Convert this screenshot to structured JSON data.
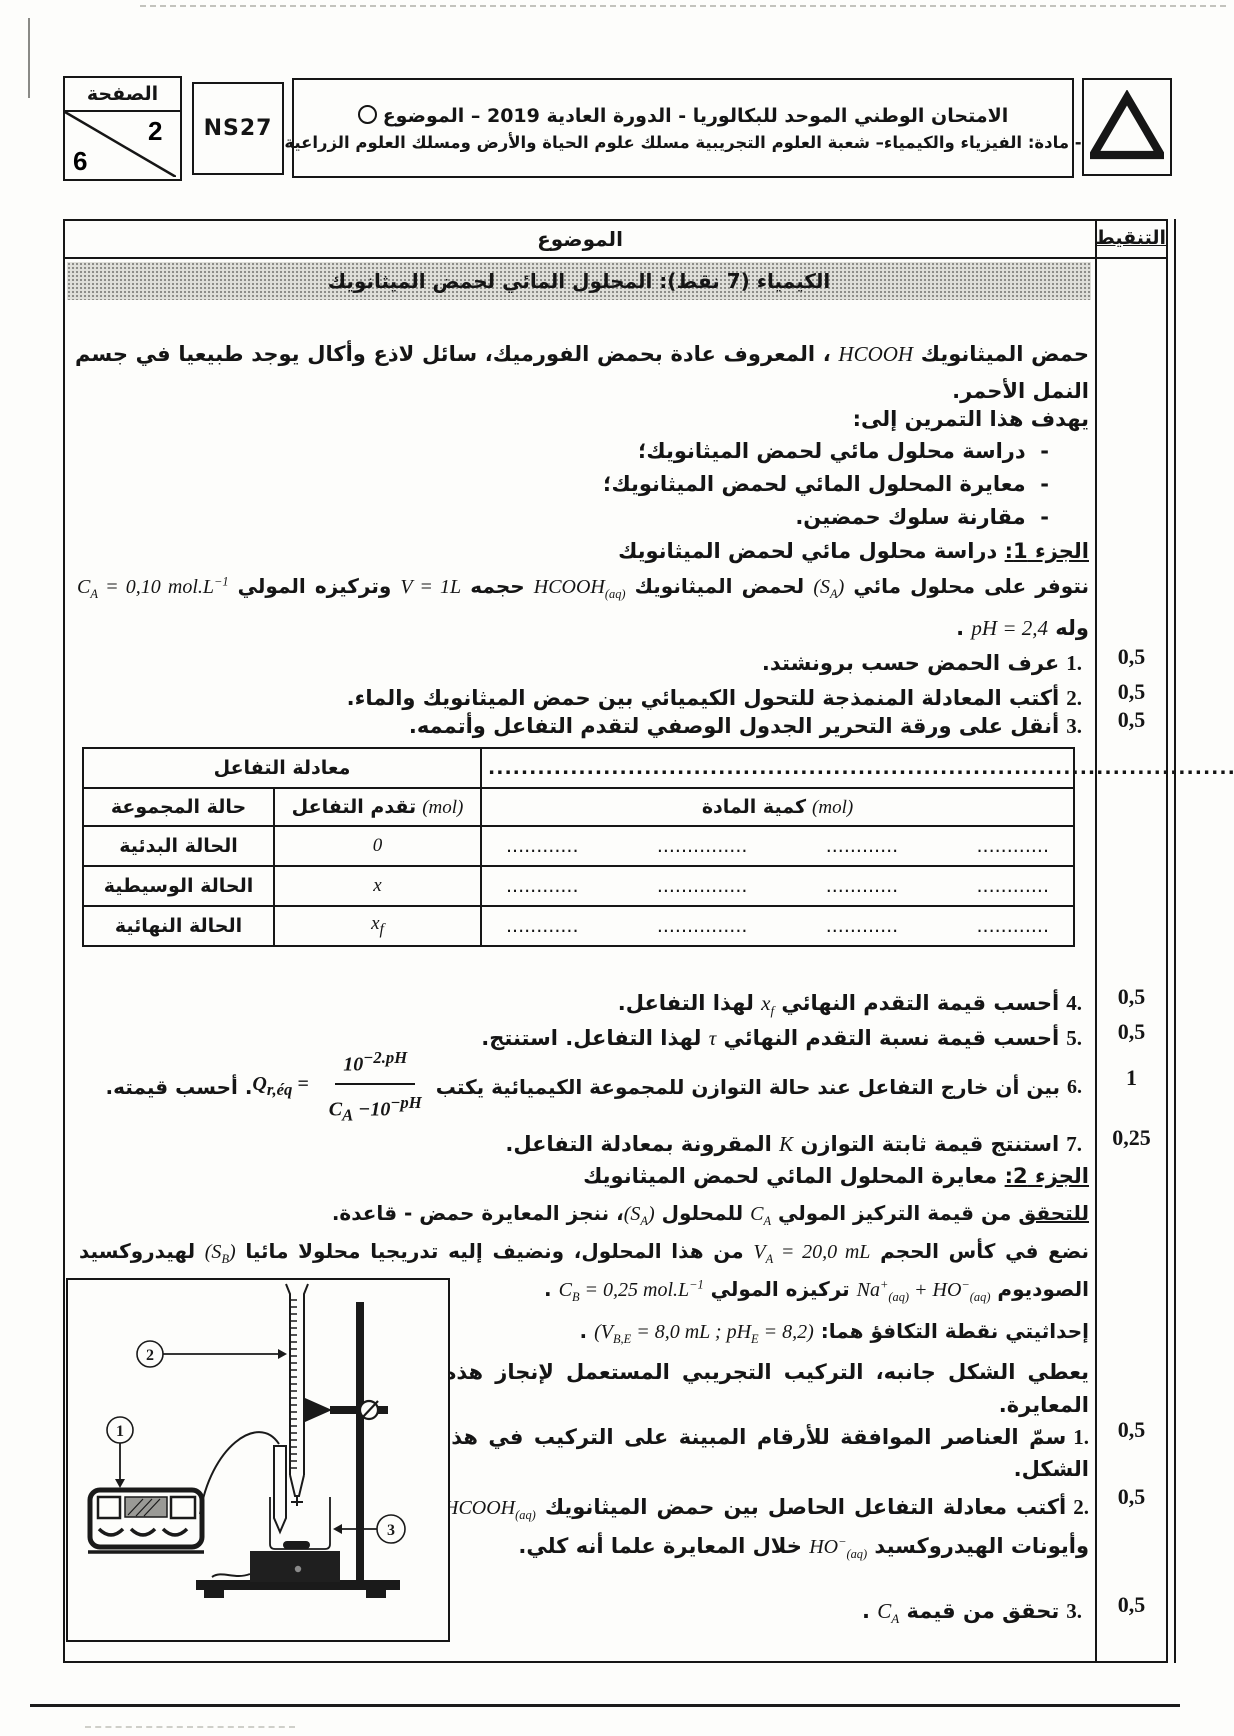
{
  "header": {
    "page_label": "الصفحة",
    "page_num": "2",
    "page_total": "6",
    "code": "NS27",
    "exam_line1": "الامتحان الوطني الموحد للبكالوريا - الدورة العادية 2019 – الموضوع",
    "exam_line2": "- مادة: الفيزياء والكيمياء– شعبة العلوم التجريبية مسلك علوم الحياة والأرض ومسلك العلوم الزراعية",
    "subject_col": "الموضوع",
    "marks_col": "التنقيط"
  },
  "banner": {
    "title": "الكيمياء (7 نقط): المحلول المائي لحمض الميثانويك"
  },
  "intro": {
    "p1a": "حمض الميثانويك ",
    "p1m": "HCOOH",
    "p1b": " ، المعروف عادة بحمض الفورميك، سائل لاذع وأكال يوجد طبيعيا في جسم النمل الأحمر.",
    "aims_title": "يهدف هذا التمرين إلى:",
    "dash": "-",
    "aims": [
      "دراسة محلول مائي لحمض الميثانويك؛",
      "معايرة المحلول المائي لحمض الميثانويك؛",
      "مقارنة سلوك حمضين."
    ]
  },
  "part1": {
    "heading_label": "الجزء 1:",
    "heading_rest": " دراسة محلول مائي لحمض الميثانويك",
    "line1_a": "نتوفر على محلول مائي ",
    "line1_sa": "(S_{A})",
    "line1_b": " لحمض الميثانويك ",
    "line1_hcooh": "HCOOH_{(aq)}",
    "line1_c": " حجمه ",
    "line1_v": "V = 1L",
    "line1_d": " وتركيزه المولي ",
    "line1_ca": "C_{A} = 0,10 mol.L^{−1}",
    "ph_a": "وله ",
    "ph_m": "pH = 2,4",
    "ph_b": " .",
    "q1": {
      "num": "1.",
      "text": "عرف الحمض حسب برونشتد."
    },
    "q2": {
      "num": "2.",
      "text": "أكتب المعادلة المنمذجة للتحول الكيميائي بين حمض الميثانويك والماء."
    },
    "q3": {
      "num": "3.",
      "text": "أنقل على ورقة التحرير الجدول الوصفي لتقدم التفاعل وأتممه."
    },
    "q4": {
      "num": "4.",
      "a": "أحسب قيمة التقدم النهائي ",
      "m": "x_{f}",
      "b": " لهذا التفاعل."
    },
    "q5": {
      "num": "5.",
      "a": "أحسب قيمة نسبة التقدم النهائي ",
      "m": "τ",
      "b": " لهذا التفاعل. استنتج."
    },
    "q6": {
      "num": "6.",
      "a": "بين أن خارج التفاعل عند حالة التوازن للمجموعة الكيميائية يكتب ",
      "lhs": "Q_{r,éq} =",
      "numf": "10^{−2.pH}",
      "denf": "C_{A} −10^{−pH}",
      "b": ". أحسب  قيمته."
    },
    "q7": {
      "num": "7.",
      "a": "استنتج قيمة ثابتة التوازن ",
      "m": "K",
      "b": " المقرونة بمعادلة التفاعل."
    }
  },
  "table": {
    "eq_label": "معادلة التفاعل",
    "eq_dots": "....................................................................................................",
    "state_col": "حالة المجموعة",
    "progress_col": "تقدم التفاعل",
    "amount_col": "كمية المادة",
    "mol": "(mol)",
    "rows": [
      {
        "state": "الحالة البدئية",
        "x": "0"
      },
      {
        "state": "الحالة الوسيطية",
        "x": "x"
      },
      {
        "state": "الحالة النهائية",
        "x": "x_{f}"
      }
    ],
    "dots": [
      "............",
      "...............",
      "............",
      "............"
    ]
  },
  "part2": {
    "heading_label": "الجزء 2:",
    "heading_rest": " معايرة المحلول المائي لحمض الميثانويك",
    "l1_u": "للتحقق",
    "l1_a": " من قيمة التركيز المولي ",
    "l1_ca": "C_{A}",
    "l1_b": " للمحلول ",
    "l1_sa": "(S_{A})",
    "l1_c": "، ننجز المعايرة حمض - قاعدة.",
    "l2_a": "نضع في كأس الحجم ",
    "l2_va": "V_{A} = 20,0 mL",
    "l2_b": " من هذا المحلول، ونضيف إليه تدريجيا محلولا مائيا ",
    "l2_sb": "(S_{B})",
    "l2_c": " لهيدروكسيد",
    "l3_a": "الصوديوم ",
    "l3_ions": "Na^{+}_{(aq)} + HO^{−}_{(aq)}",
    "l3_b": " تركيزه المولي ",
    "l3_cb": "C_{B} = 0,25 mol.L^{−1}",
    "l3_c": " .",
    "l4_a": "إحداثيتي نقطة التكافؤ هما:  ",
    "l4_m": "(V_{B,E} = 8,0 mL  ;  pH_{E} = 8,2)",
    "l4_b": " .",
    "l5": "يعطي الشكل جانبه، التركيب التجريبي المستعمل لإنجاز هذه المعايرة.",
    "q1": {
      "num": "1.",
      "text": "سمّ  العناصر الموافقة للأرقام المبينة على التركيب في هذا الشكل."
    },
    "q2": {
      "num": "2.",
      "a": "أكتب معادلة التفاعل الحاصل بين حمض الميثانويك ",
      "m1": "HCOOH_{(aq)}",
      "b": " وأيونات الهيدروكسيد ",
      "m2": "HO^{−}_{(aq)}",
      "c": " خلال المعايرة علما أنه كلي."
    },
    "q3": {
      "num": "3.",
      "a": "تحقق من قيمة ",
      "m": "C_{A}",
      "b": " ."
    }
  },
  "marks": [
    "0,5",
    "0,5",
    "0,5",
    "0,5",
    "0,5",
    "1",
    "0,25",
    "0,5",
    "0,5",
    "0,5"
  ],
  "figure": {
    "labels": [
      "1",
      "2",
      "3"
    ]
  }
}
